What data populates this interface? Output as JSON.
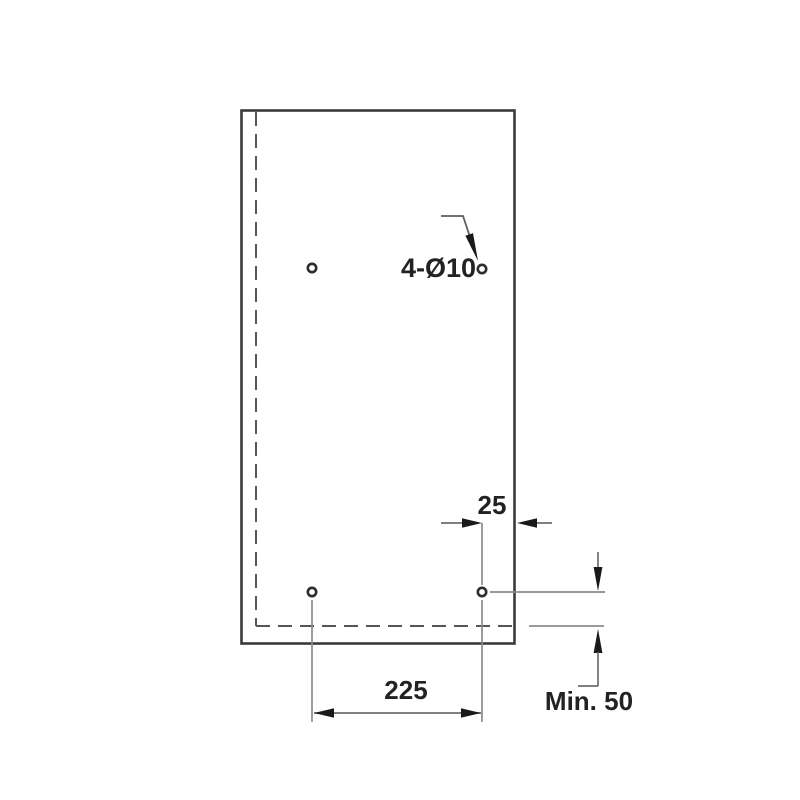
{
  "diagram": {
    "type": "technical-mounting-drawing",
    "labels": {
      "hole_spec": "4-Ø10",
      "edge_offset": "25",
      "hole_spacing": "225",
      "min_clearance": "Min. 50"
    },
    "measurements": {
      "hole_count": 4,
      "hole_diameter_mm": 10,
      "hole_spacing_mm": 225,
      "edge_offset_mm": 25,
      "min_clearance_mm": 50
    },
    "colors": {
      "background": "#ffffff",
      "panel_outline": "#3a3a3a",
      "dashed_reference": "#565656",
      "dimension_lines": "#6e6e6e",
      "extension_lines": "#8c8c8c",
      "arrowheads": "#1a1a1a",
      "text": "#222222"
    }
  }
}
